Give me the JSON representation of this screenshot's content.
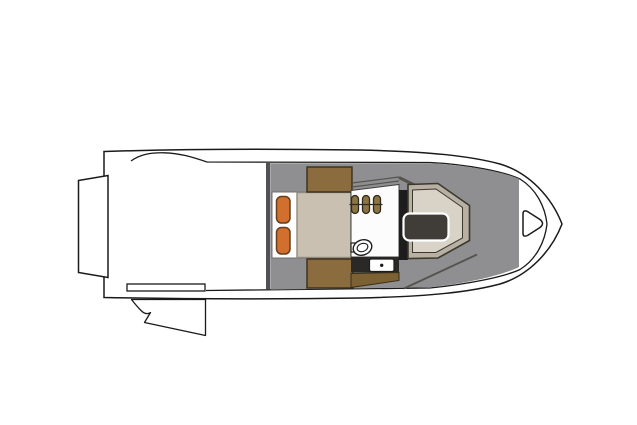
{
  "diagram": {
    "type": "boat-floorplan-top-view",
    "orientation": "bow-right",
    "parts": {
      "hull": "hull",
      "swim_platform": "swim-platform",
      "transom_door": "transom-door-with-swing-arc",
      "cockpit": "open-cockpit",
      "bulkhead": "cabin-bulkhead",
      "cabin_deck": "cabin-deck",
      "berth": "forward-berth",
      "pillows": "two-pillows",
      "mattress": "mattress",
      "cabinets": "storage-cabinets",
      "galley": "galley-counter",
      "stools": "three-stools",
      "sink": "sink",
      "stove": "stove",
      "dinette": "bow-dinette-seating",
      "table": "dinette-table",
      "anchor_locker": "bow-anchor-locker"
    },
    "colors": {
      "background": "#ffffff",
      "outline": "#1a1a1a",
      "hull": "#ffffff",
      "deck": "#8f8f91",
      "bulkhead": "#525254",
      "berth": "#ffffff",
      "berth_outline": "#6f6f6f",
      "mattress": "#c9c0b2",
      "mattress_outline": "#8f8a7c",
      "pillow": "#d06f2e",
      "pillow_outline": "#643f1d",
      "cabinet": "#8b6c3f",
      "cabinet_outline": "#3a2f1b",
      "galley": "#fcfcfc",
      "galley_outline": "#3f3f3f",
      "stool": "#8c7344",
      "stool_outline": "#2e291b",
      "counter_dark": "#2b2927",
      "counter_brown": "#7c6132",
      "stove": "#ffffff",
      "stove_outline": "#1d1d1d",
      "divider_dark": "#1d1d1d",
      "dinette_outer": "#b8b0a2",
      "dinette_inner": "#d9d3c7",
      "dinette_outline": "#3b382e",
      "table": "#403c37",
      "table_outline": "#ffffff",
      "accent_line": "#55534e",
      "locker": "#ffffff"
    }
  }
}
